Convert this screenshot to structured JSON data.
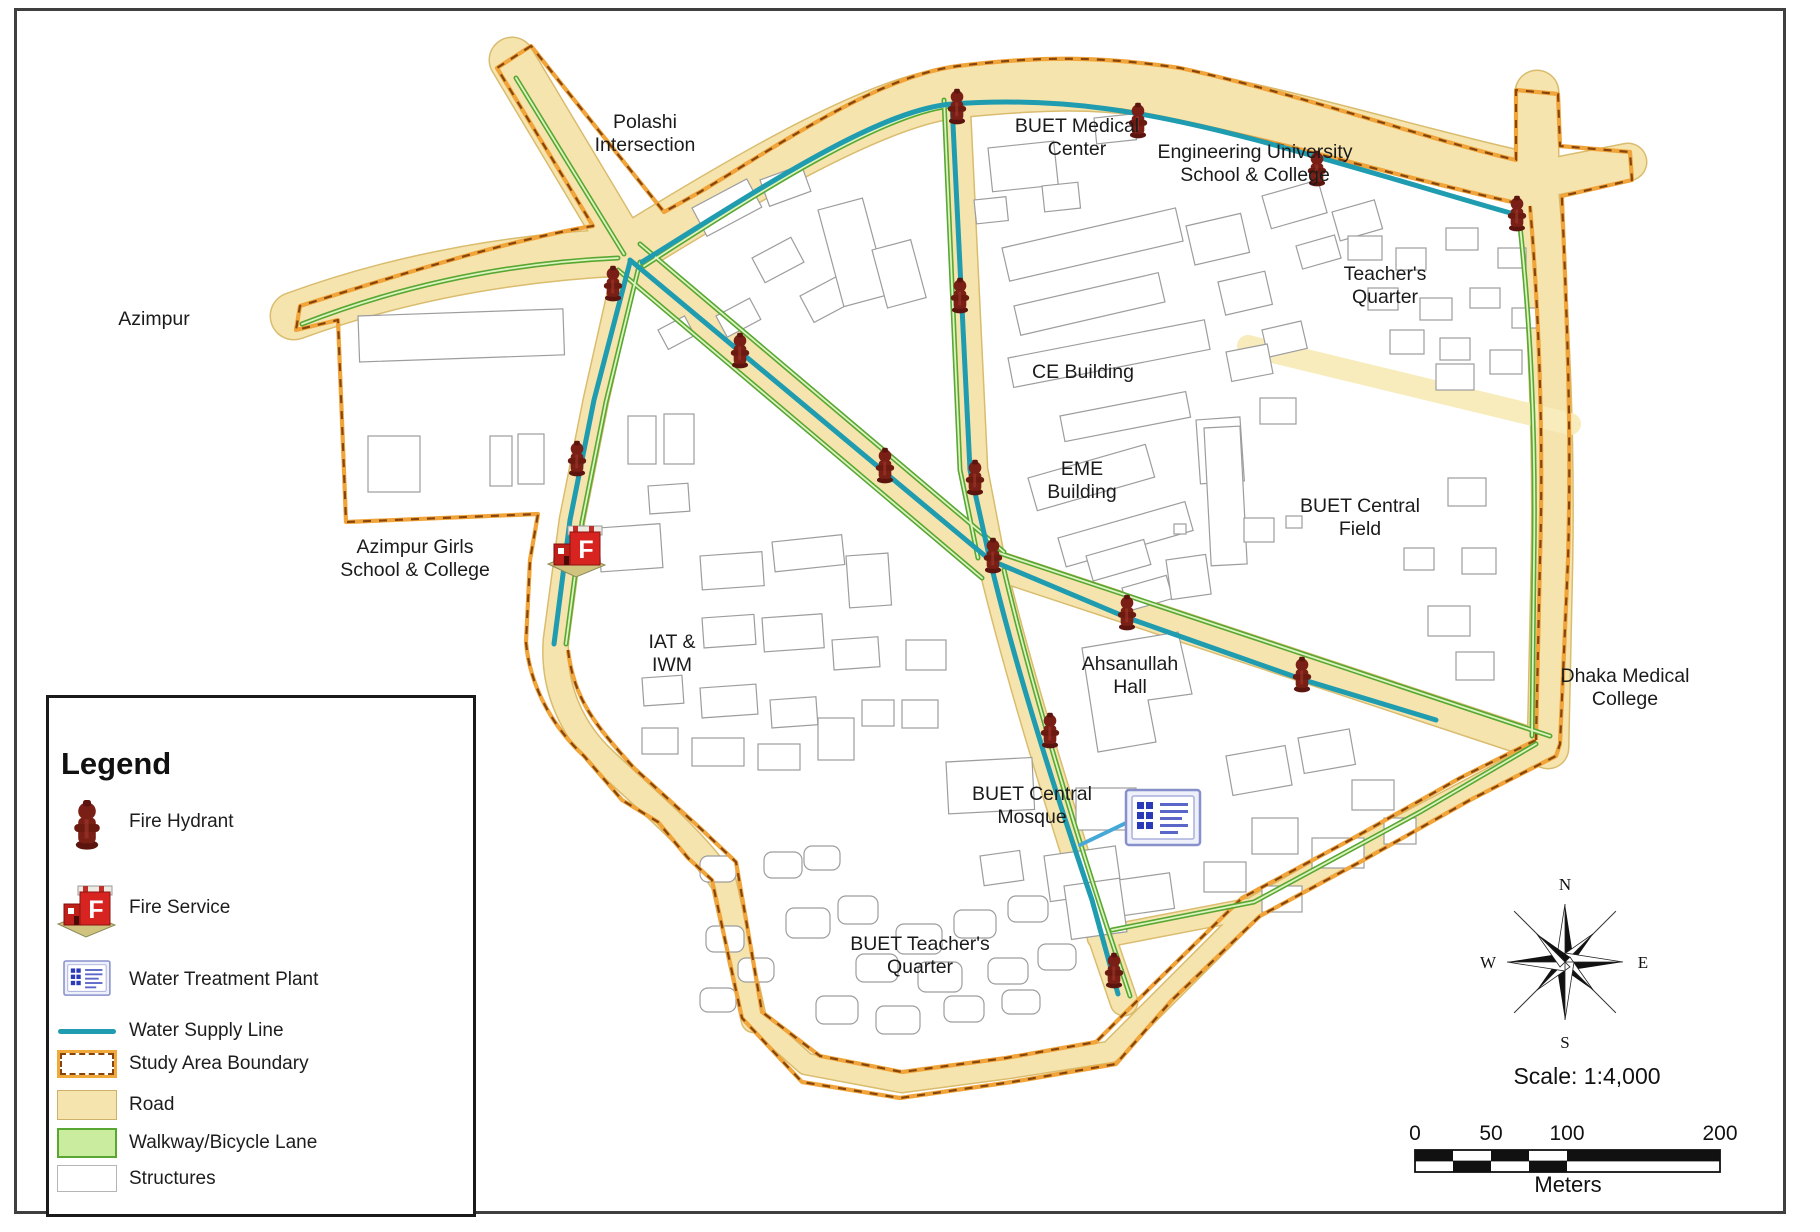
{
  "labels": [
    {
      "lines": [
        "Polashi",
        "Intersection"
      ]
    },
    {
      "lines": [
        "Azimpur"
      ]
    },
    {
      "lines": [
        "BUET Medical",
        "Center"
      ]
    },
    {
      "lines": [
        "Engineering University",
        "School & College"
      ]
    },
    {
      "lines": [
        "Teacher's",
        "Quarter"
      ]
    },
    {
      "lines": [
        "CE Building"
      ]
    },
    {
      "lines": [
        "EME",
        "Building"
      ]
    },
    {
      "lines": [
        "BUET Central",
        "Field"
      ]
    },
    {
      "lines": [
        "Azimpur Girls",
        "School & College"
      ]
    },
    {
      "lines": [
        "IAT &",
        "IWM"
      ]
    },
    {
      "lines": [
        "Ahsanullah",
        "Hall"
      ]
    },
    {
      "lines": [
        "Dhaka Medical",
        "College"
      ]
    },
    {
      "lines": [
        "BUET Central",
        "Mosque"
      ]
    },
    {
      "lines": [
        "BUET Teacher's",
        "Quarter"
      ]
    }
  ],
  "legend": {
    "title": "Legend",
    "items": [
      {
        "label": "Fire Hydrant"
      },
      {
        "label": "Fire Service"
      },
      {
        "label": "Water Treatment Plant"
      },
      {
        "label": "Water Supply Line"
      },
      {
        "label": "Study Area Boundary"
      },
      {
        "label": "Road"
      },
      {
        "label": "Walkway/Bicycle Lane"
      },
      {
        "label": "Structures"
      }
    ]
  },
  "compass": {
    "n": "N",
    "e": "E",
    "s": "S",
    "w": "W"
  },
  "scalebar": {
    "title": "Scale: 1:4,000",
    "ticks": [
      "0",
      "50",
      "100",
      "200"
    ],
    "unit": "Meters"
  },
  "icons": {
    "fire_service_letter": "F"
  },
  "colors": {
    "road": "#f6e4ae",
    "road_edge": "#d9bc6e",
    "boundary_orange": "#f0a43a",
    "boundary_dark": "#86450c",
    "walkway_green": "#59a733",
    "walkway_fill": "#c9ec9f",
    "water_line": "#1f9caf",
    "wtp_branch": "#45a8d8",
    "hydrant": "#7a1f15",
    "fire_service_red": "#d82420",
    "wtp_blue": "#2a3ab8",
    "structure_stroke": "#9d9d9d"
  }
}
